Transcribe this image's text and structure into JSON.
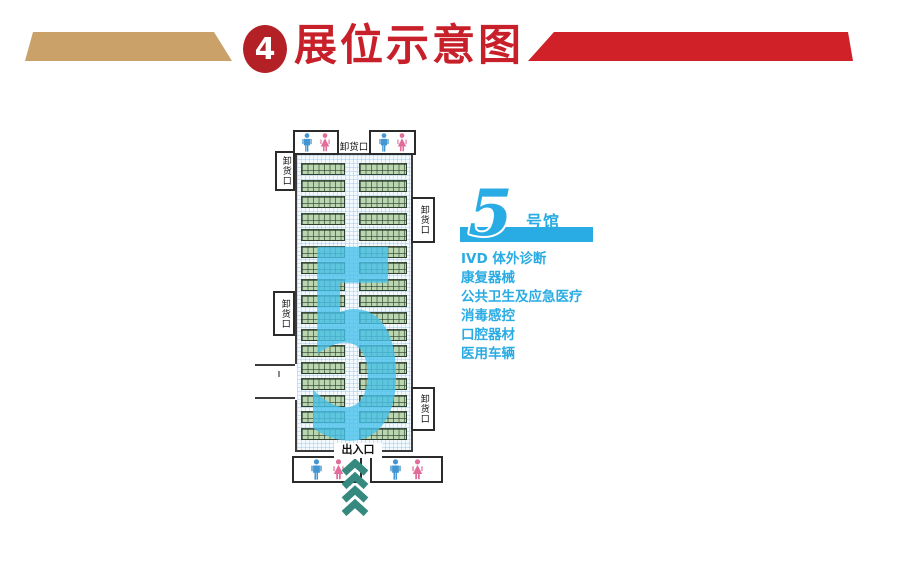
{
  "header": {
    "badge_number": "4",
    "title": "展位示意图"
  },
  "floorplan": {
    "hall_number": "5",
    "booth_row_count": 17,
    "entrance_label": "出入口",
    "docks": {
      "top": "卸货口",
      "left_upper": "卸货口",
      "left_middle": "卸货口",
      "right_upper": "卸货口",
      "right_lower": "卸货口"
    },
    "icons": {
      "restrooms": [
        "male-figure-icon",
        "female-figure-icon"
      ],
      "entrance_arrows": "chevron-up-arrows-icon"
    }
  },
  "legend": {
    "hall_number": "5",
    "hall_label_suffix": "号馆",
    "items": [
      "IVD 体外诊断",
      "康复器械",
      "公共卫生及应急医疗",
      "消毒感控",
      "口腔器材",
      "医用车辆"
    ]
  },
  "colors": {
    "ribbon_tan": "#c9a169",
    "ribbon_red": "#d02128",
    "badge_red": "#b32025",
    "title_red": "#c8202a",
    "legend_cyan": "#29abe3",
    "hall_number_blue": "#48c2eb",
    "booth_green": "#b9d6b1",
    "wall_gray": "#3b3b3b",
    "restroom_blue": "#4396d1",
    "restroom_pink": "#e06d9a",
    "arrow_teal": "#35897e"
  }
}
